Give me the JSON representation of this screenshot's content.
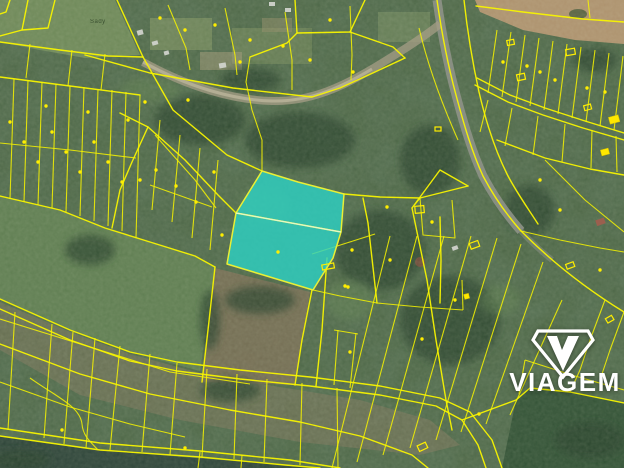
{
  "map": {
    "type": "cadastral-aerial-overlay",
    "area_label": "Sady",
    "highlight": {
      "parcel_count": 2,
      "fill": "#2cd2c4",
      "outline": "#e9ef35"
    },
    "colors": {
      "parcel_line": "#f8f400",
      "marker_dot": "#ffee00",
      "forest": "#46603e",
      "field_green": "#5c7b4f",
      "field_tan": "#ac906c",
      "road": "#8e9287",
      "water": "#2b4237"
    }
  },
  "watermark": {
    "label": "VIAGEM",
    "icon": "viagem-gem-icon",
    "color": "#ffffff"
  }
}
